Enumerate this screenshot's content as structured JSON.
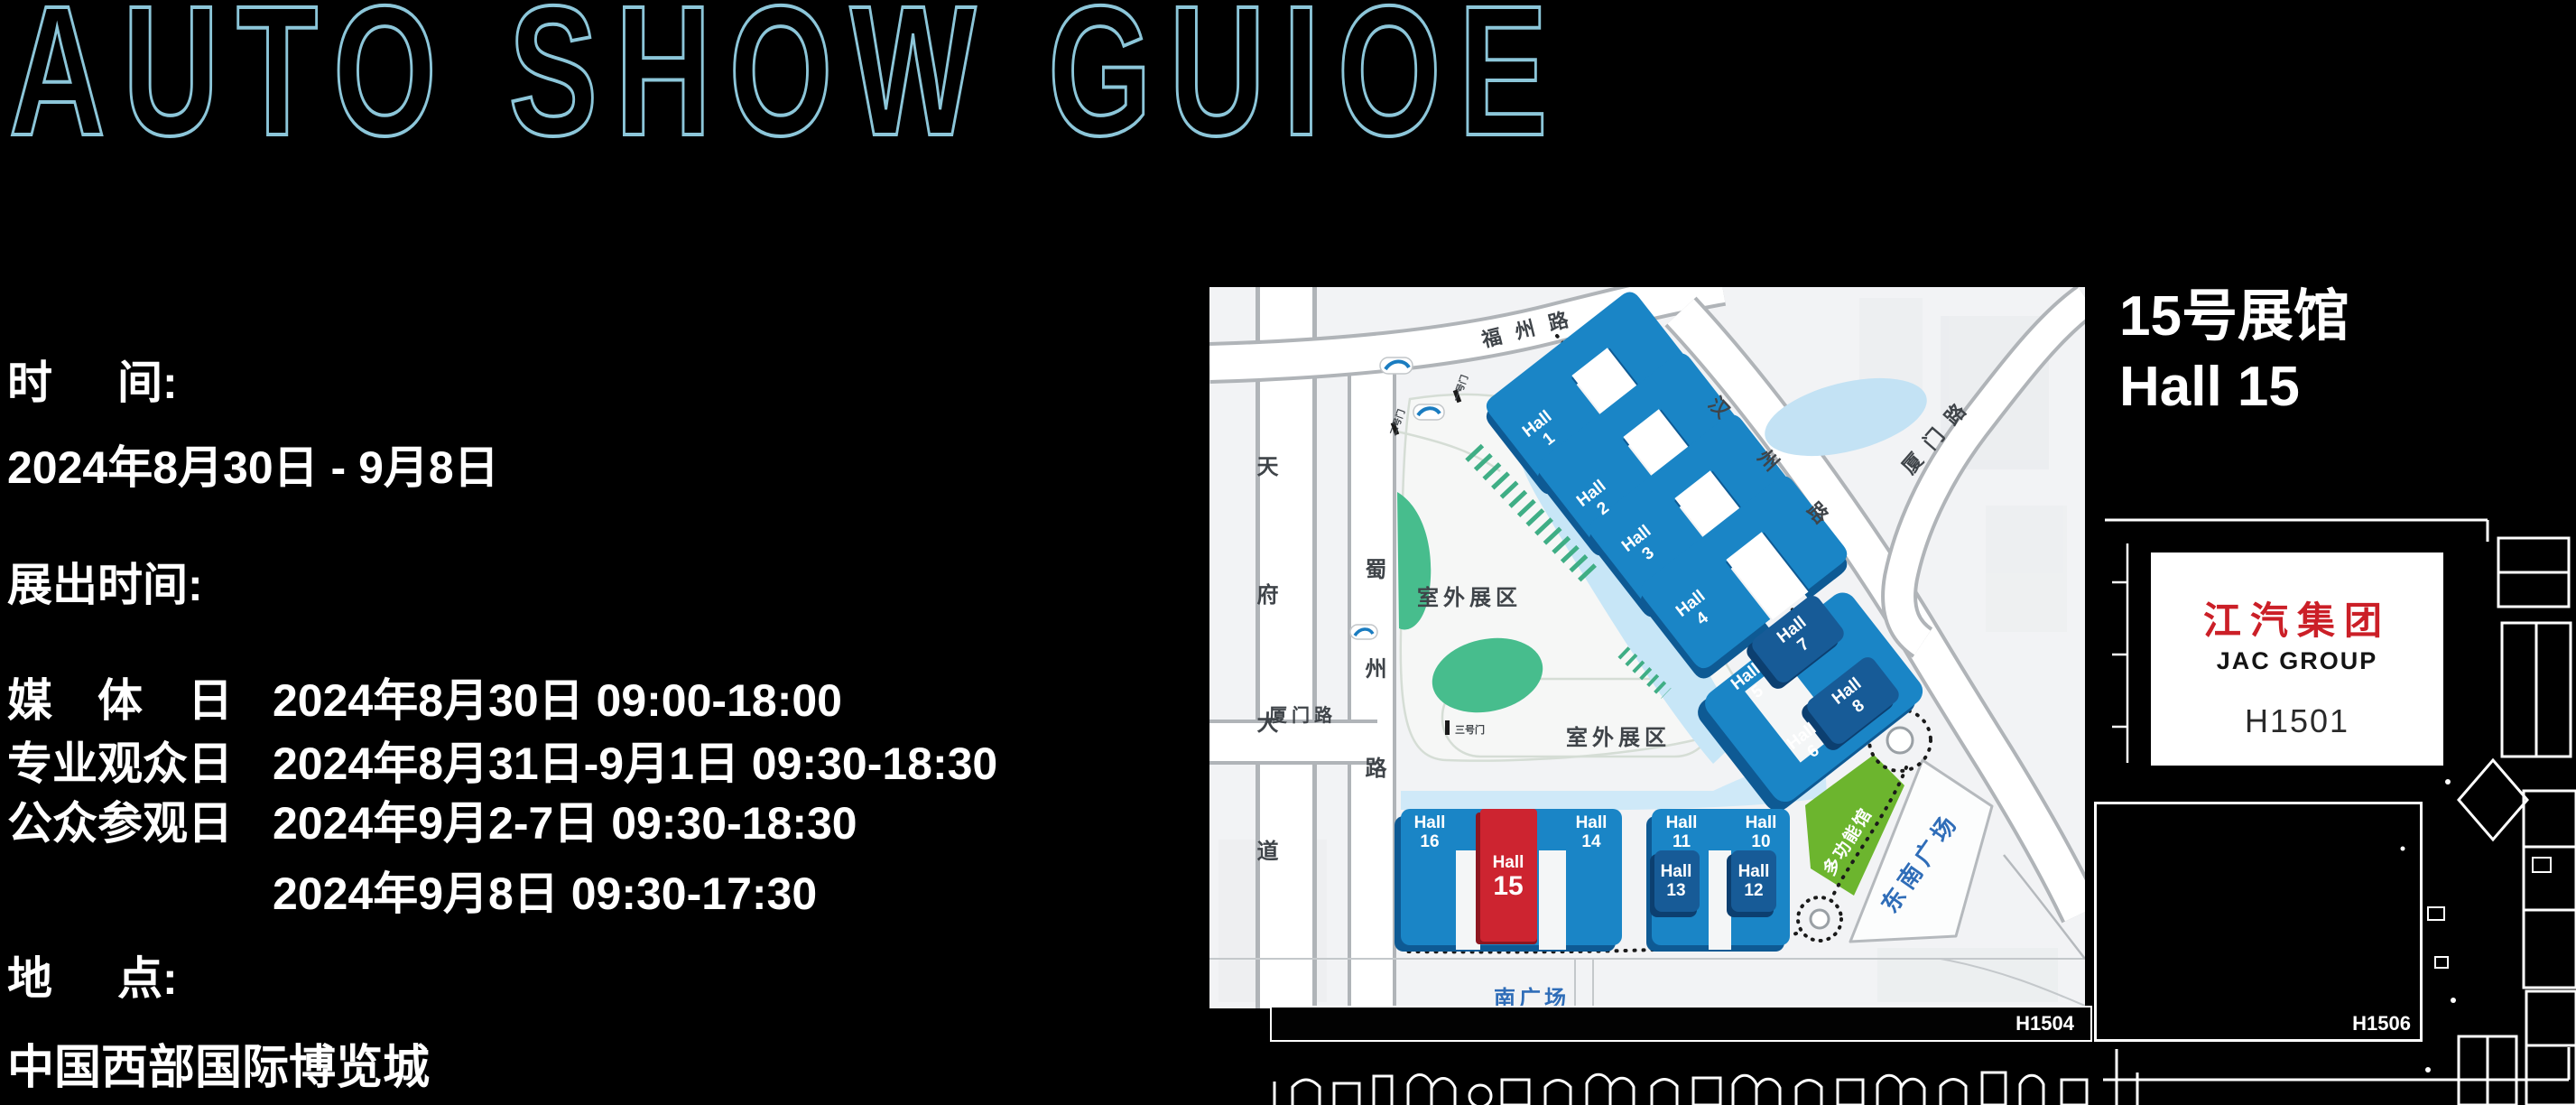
{
  "title": "AUTO SHOW GUIOE",
  "info": {
    "time_label_a": "时",
    "time_label_b": "间:",
    "date_range": "2024年8月30日 - 9月8日",
    "hours_label": "展出时间:",
    "schedule": [
      {
        "label": "媒　体　日",
        "text": "2024年8月30日  09:00-18:00"
      },
      {
        "label": "专业观众日",
        "text": "2024年8月31日-9月1日  09:30-18:30"
      },
      {
        "label": "公众参观日",
        "text": "2024年9月2-7日  09:30-18:30"
      },
      {
        "label": "",
        "text": "2024年9月8日  09:30-17:30"
      }
    ],
    "venue_label_a": "地",
    "venue_label_b": "点:",
    "venue_name": "中国西部国际博览城"
  },
  "callout": {
    "line1": "15号展馆",
    "line2": "Hall 15"
  },
  "booth": {
    "logo_cn": "江汽集团",
    "logo_en": "JAC GROUP",
    "number": "H1501"
  },
  "floorplan": {
    "bottom_bar_label": "H1504",
    "right_booth_label": "H1506"
  },
  "map": {
    "roads": {
      "fuzhou": "福州路",
      "hanzhou": "汉州路",
      "xiamen_e": "厦门路",
      "xiamen_w": "厦门路",
      "tianfu": "天府大道",
      "shuzhou": "蜀州路"
    },
    "areas": {
      "outdoor_a": "室外展区",
      "outdoor_b": "室外展区",
      "multi_hall": "多功能馆",
      "se_plaza": "东南广场",
      "south_plaza": "南广场"
    },
    "gates": {
      "gate1": "一号门",
      "gate2": "二号门",
      "gate3": "三号门"
    },
    "halls": {
      "h1": {
        "name": "Hall",
        "num": "1"
      },
      "h2": {
        "name": "Hall",
        "num": "2"
      },
      "h3": {
        "name": "Hall",
        "num": "3"
      },
      "h4": {
        "name": "Hall",
        "num": "4"
      },
      "h5": {
        "name": "Hall",
        "num": "5"
      },
      "h6": {
        "name": "Hall",
        "num": "6"
      },
      "h7": {
        "name": "Hall",
        "num": "7"
      },
      "h8": {
        "name": "Hall",
        "num": "8"
      },
      "h10": {
        "name": "Hall",
        "num": "10"
      },
      "h11": {
        "name": "Hall",
        "num": "11"
      },
      "h12": {
        "name": "Hall",
        "num": "12"
      },
      "h13": {
        "name": "Hall",
        "num": "13"
      },
      "h14": {
        "name": "Hall",
        "num": "14"
      },
      "h15": {
        "name": "Hall",
        "num": "15"
      },
      "h16": {
        "name": "Hall",
        "num": "16"
      }
    },
    "colors": {
      "hall_blue": "#1a85c6",
      "hall_blue_dark": "#0e5a94",
      "hall_navy": "#175b97",
      "highlight_red": "#cd2430",
      "multi_green": "#6cb52e",
      "park_teal": "#47bd8d",
      "water": "#c7e6f7",
      "plaza_text": "#2f6db8",
      "title_stroke": "#8cc6d9"
    }
  }
}
